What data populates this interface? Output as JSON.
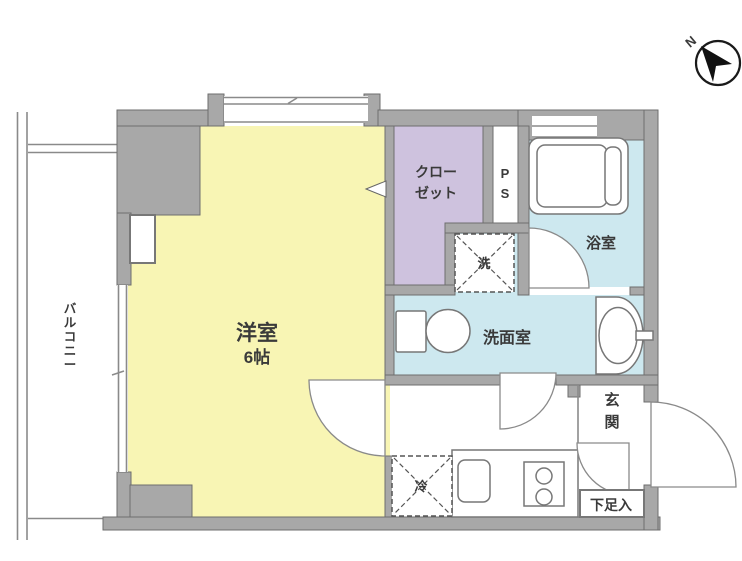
{
  "title": "1K apartment floor plan",
  "colors": {
    "room_yellow": "#F8F5B4",
    "closet_lavender": "#CEC2DE",
    "wet_blue": "#CDE8EF",
    "wall_gray": "#A8A8A8"
  },
  "labels": {
    "room_name": "洋室",
    "room_size": "6帖",
    "closet_1": "クロー",
    "closet_2": "ゼット",
    "ps_p": "P",
    "ps_s": "S",
    "bath": "浴室",
    "wash": "洗",
    "washroom": "洗面室",
    "fridge": "冷",
    "genkan_1": "玄",
    "genkan_2": "関",
    "shoe": "下足入",
    "balcony_1": "バ",
    "balcony_2": "ル",
    "balcony_3": "コ",
    "balcony_4": "ニ",
    "balcony_5": "ー",
    "north": "N"
  }
}
